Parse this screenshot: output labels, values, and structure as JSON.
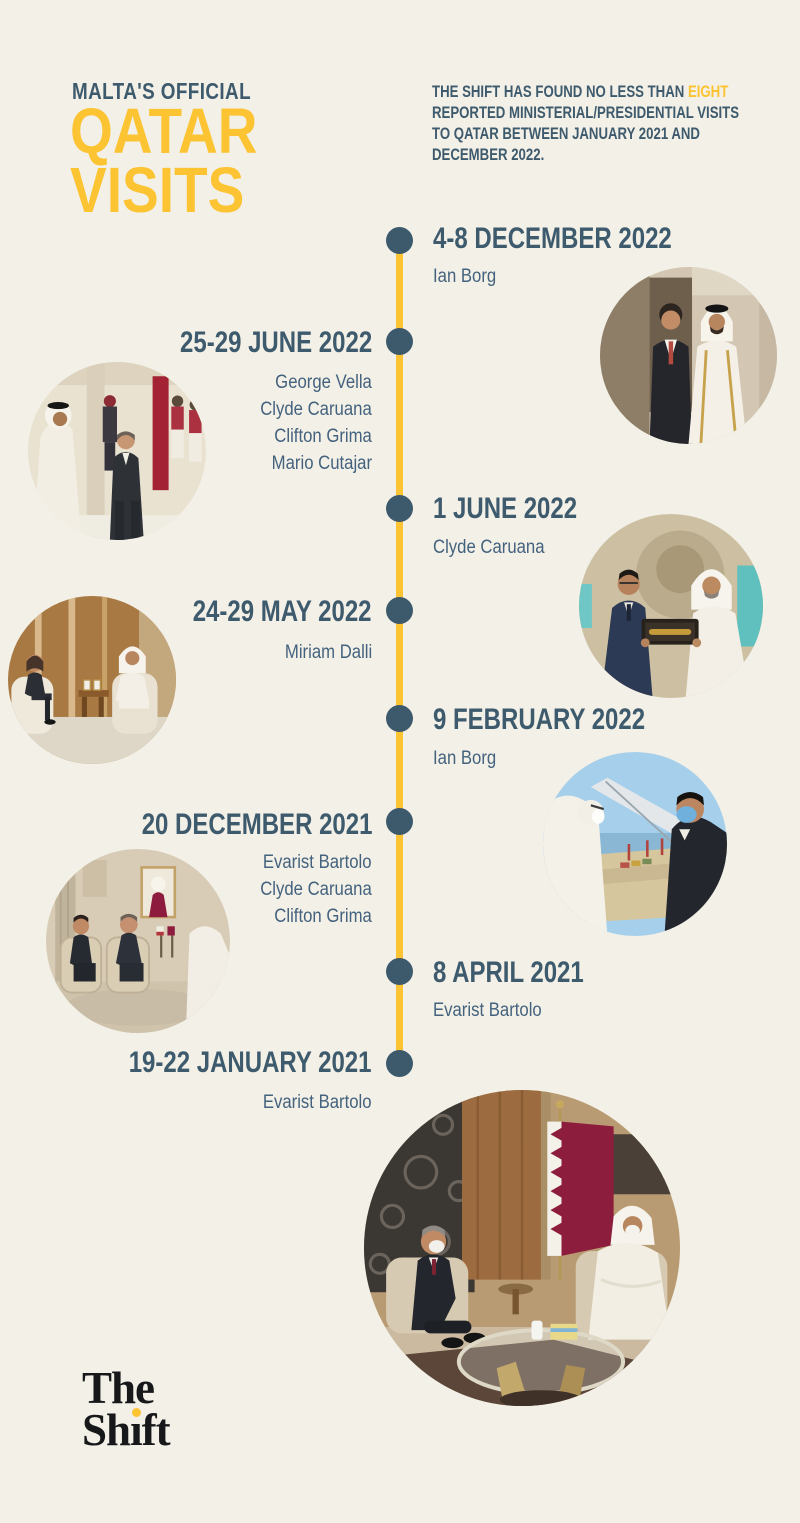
{
  "page": {
    "background": "#f2f0e7"
  },
  "colors": {
    "accent_yellow": "#fcc332",
    "heading_teal": "#3e5a6d",
    "name_teal": "#44627e",
    "timeline_line": "#fcc332",
    "timeline_dot": "#3d5a6d",
    "logo_black": "#17181a"
  },
  "header": {
    "kicker": "MALTA'S OFFICIAL",
    "title_line1": "QATAR",
    "title_line2": "VISITS",
    "intro_line1_pre": "THE SHIFT HAS FOUND NO LESS THAN ",
    "intro_line1_hl": "EIGHT",
    "intro_line2": "REPORTED MINISTERIAL/PRESIDENTIAL VISITS",
    "intro_line3": "TO QATAR BETWEEN JANUARY 2021 AND",
    "intro_line4": "DECEMBER 2022."
  },
  "timeline": {
    "entries": [
      {
        "date": "4-8 DECEMBER 2022",
        "side": "right",
        "names": [
          "Ian Borg"
        ],
        "photo_alt": "Ian Borg standing beside Qatari official in white bisht"
      },
      {
        "date": "25-29 JUNE 2022",
        "side": "left",
        "names": [
          "George Vella",
          "Clyde Caruana",
          "Clifton Grima",
          "Mario Cutajar"
        ],
        "photo_alt": "State welcome ceremony with honour guard"
      },
      {
        "date": "1 JUNE 2022",
        "side": "right",
        "names": [
          "Clyde Caruana"
        ],
        "photo_alt": "Clyde Caruana receiving gift box from Qatari official"
      },
      {
        "date": "24-29 MAY 2022",
        "side": "left",
        "names": [
          "Miriam Dalli"
        ],
        "photo_alt": "Miriam Dalli seated meeting in wood-panelled room"
      },
      {
        "date": "9 FEBRUARY 2022",
        "side": "right",
        "names": [
          "Ian Borg"
        ],
        "photo_alt": "Ian Borg in face mask overlooking port from tower"
      },
      {
        "date": "20 DECEMBER 2021",
        "side": "left",
        "names": [
          "Evarist Bartolo",
          "Clyde Caruana",
          "Clifton Grima"
        ],
        "photo_alt": "Delegation seated meeting with flags and emir portrait"
      },
      {
        "date": "8 APRIL 2021",
        "side": "right",
        "names": [
          "Evarist Bartolo"
        ],
        "photo_alt": ""
      },
      {
        "date": "19-22 JANUARY 2021",
        "side": "left",
        "names": [
          "Evarist Bartolo"
        ],
        "photo_alt": "Evarist Bartolo seated meeting with Qatari flag and glass table"
      }
    ]
  },
  "footer": {
    "logo_line1": "The",
    "logo_line2_a": "Sh",
    "logo_line2_i": "ı",
    "logo_line2_b": "ft"
  }
}
